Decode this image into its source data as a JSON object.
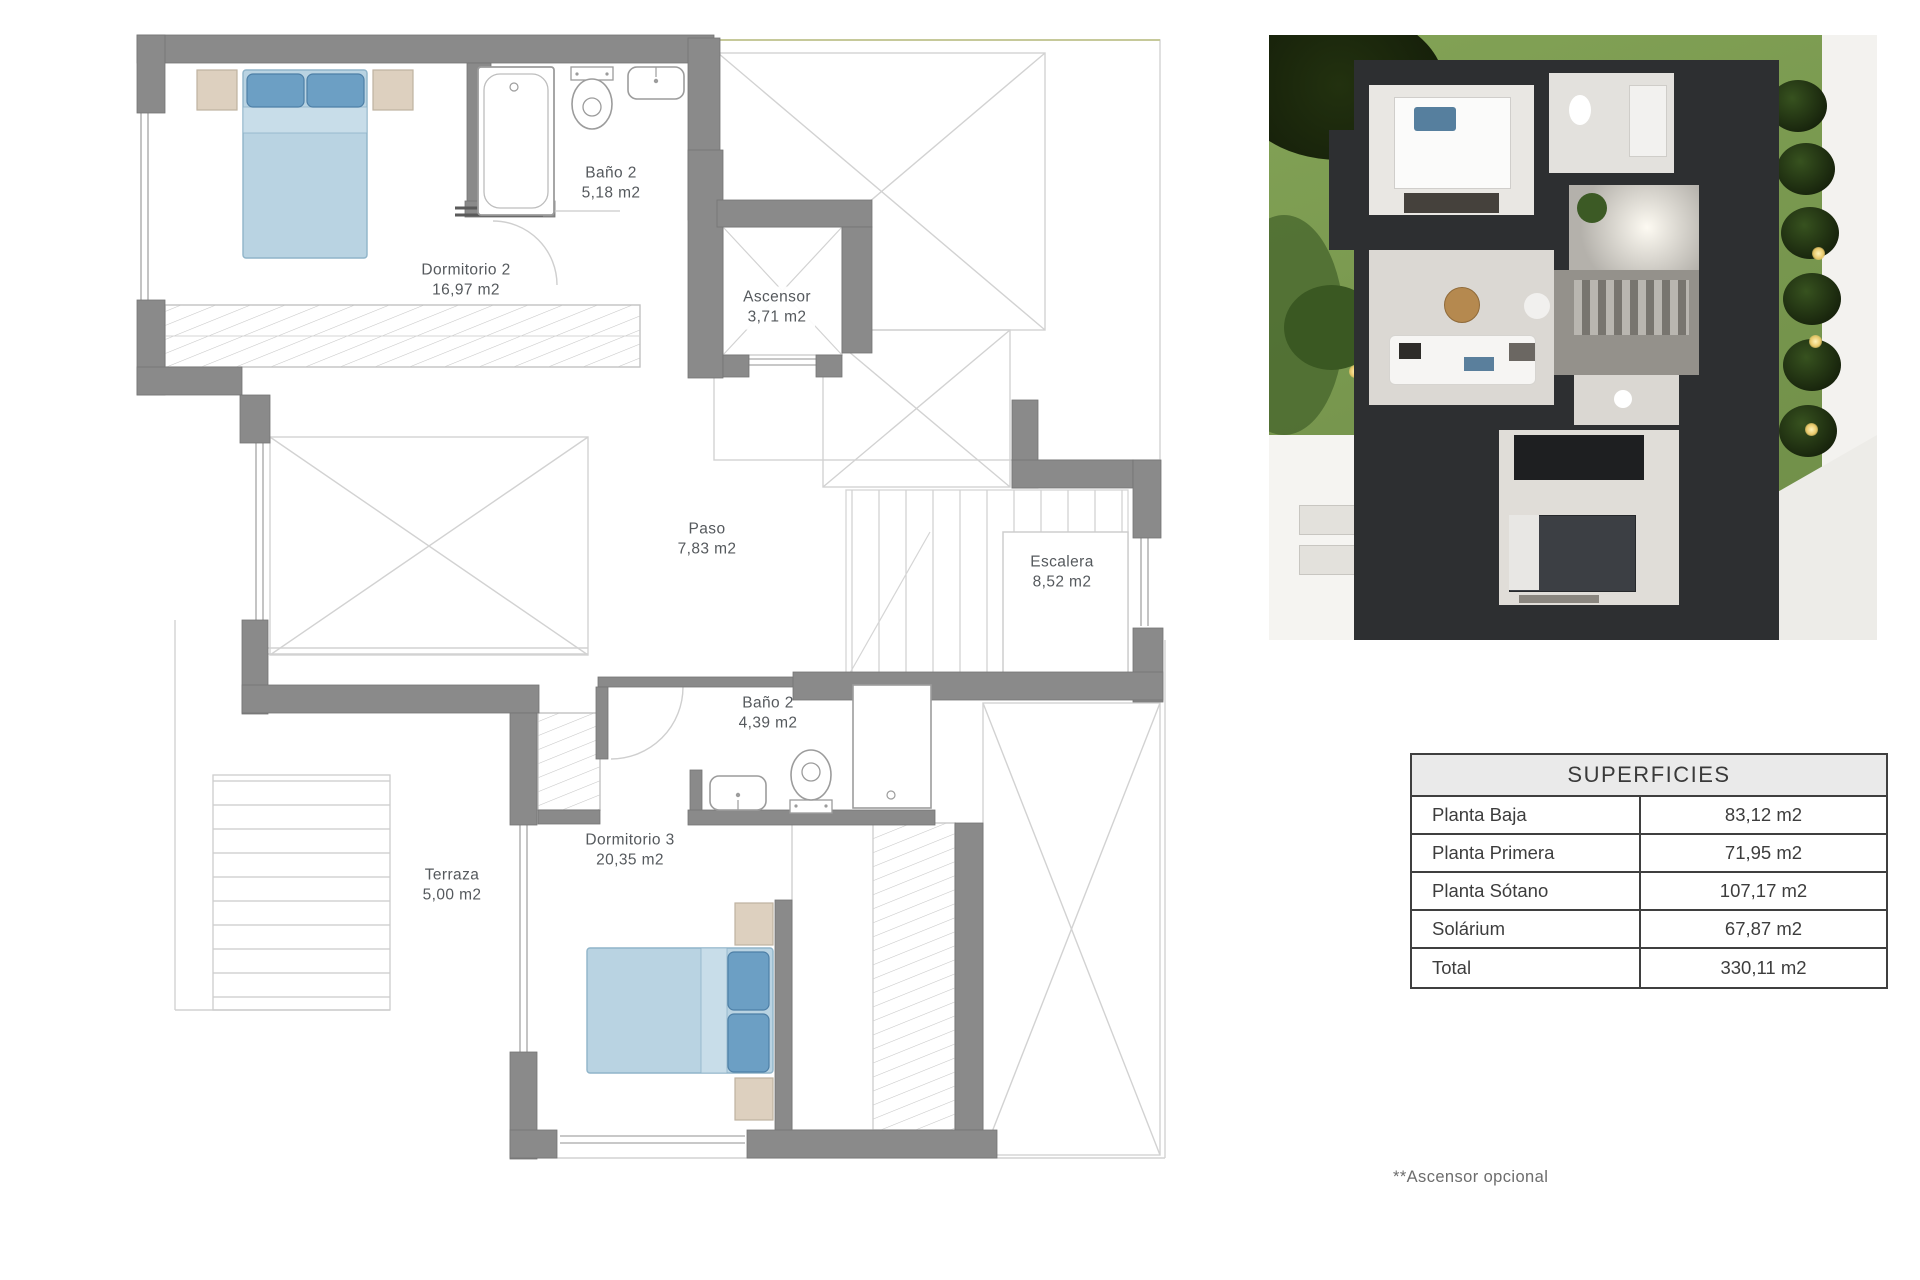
{
  "floor_plan": {
    "rooms": [
      {
        "name": "Dormitorio 2",
        "area": "16,97 m2"
      },
      {
        "name": "Baño 2",
        "area": "5,18 m2"
      },
      {
        "name": "Ascensor",
        "area": "3,71 m2"
      },
      {
        "name": "Paso",
        "area": "7,83 m2"
      },
      {
        "name": "Escalera",
        "area": "8,52 m2"
      },
      {
        "name": "Baño 2",
        "area": "4,39 m2"
      },
      {
        "name": "Dormitorio 3",
        "area": "20,35 m2"
      },
      {
        "name": "Terraza",
        "area": "5,00 m2"
      }
    ]
  },
  "surfaces_table": {
    "title": "SUPERFICIES",
    "rows": [
      {
        "label": "Planta Baja",
        "value": "83,12 m2"
      },
      {
        "label": "Planta Primera",
        "value": "71,95 m2"
      },
      {
        "label": "Planta Sótano",
        "value": "107,17 m2"
      },
      {
        "label": "Solárium",
        "value": "67,87 m2"
      },
      {
        "label": "Total",
        "value": "330,11 m2"
      }
    ]
  },
  "footnote": "**Ascensor opcional",
  "colors": {
    "wall_gray": "#8a8a8a",
    "thin_line": "#c9c9c9",
    "bed_body_blue": "#b9d3e2",
    "pillow_blue": "#6c9fc4",
    "nightstand_beige": "#ddd0bf",
    "label_text": "#55595d",
    "table_border": "#3f3f3f",
    "table_header_bg": "#eaeaea",
    "render_lawn_green": "#7a9a50",
    "render_building_dark": "#2d2f31"
  }
}
